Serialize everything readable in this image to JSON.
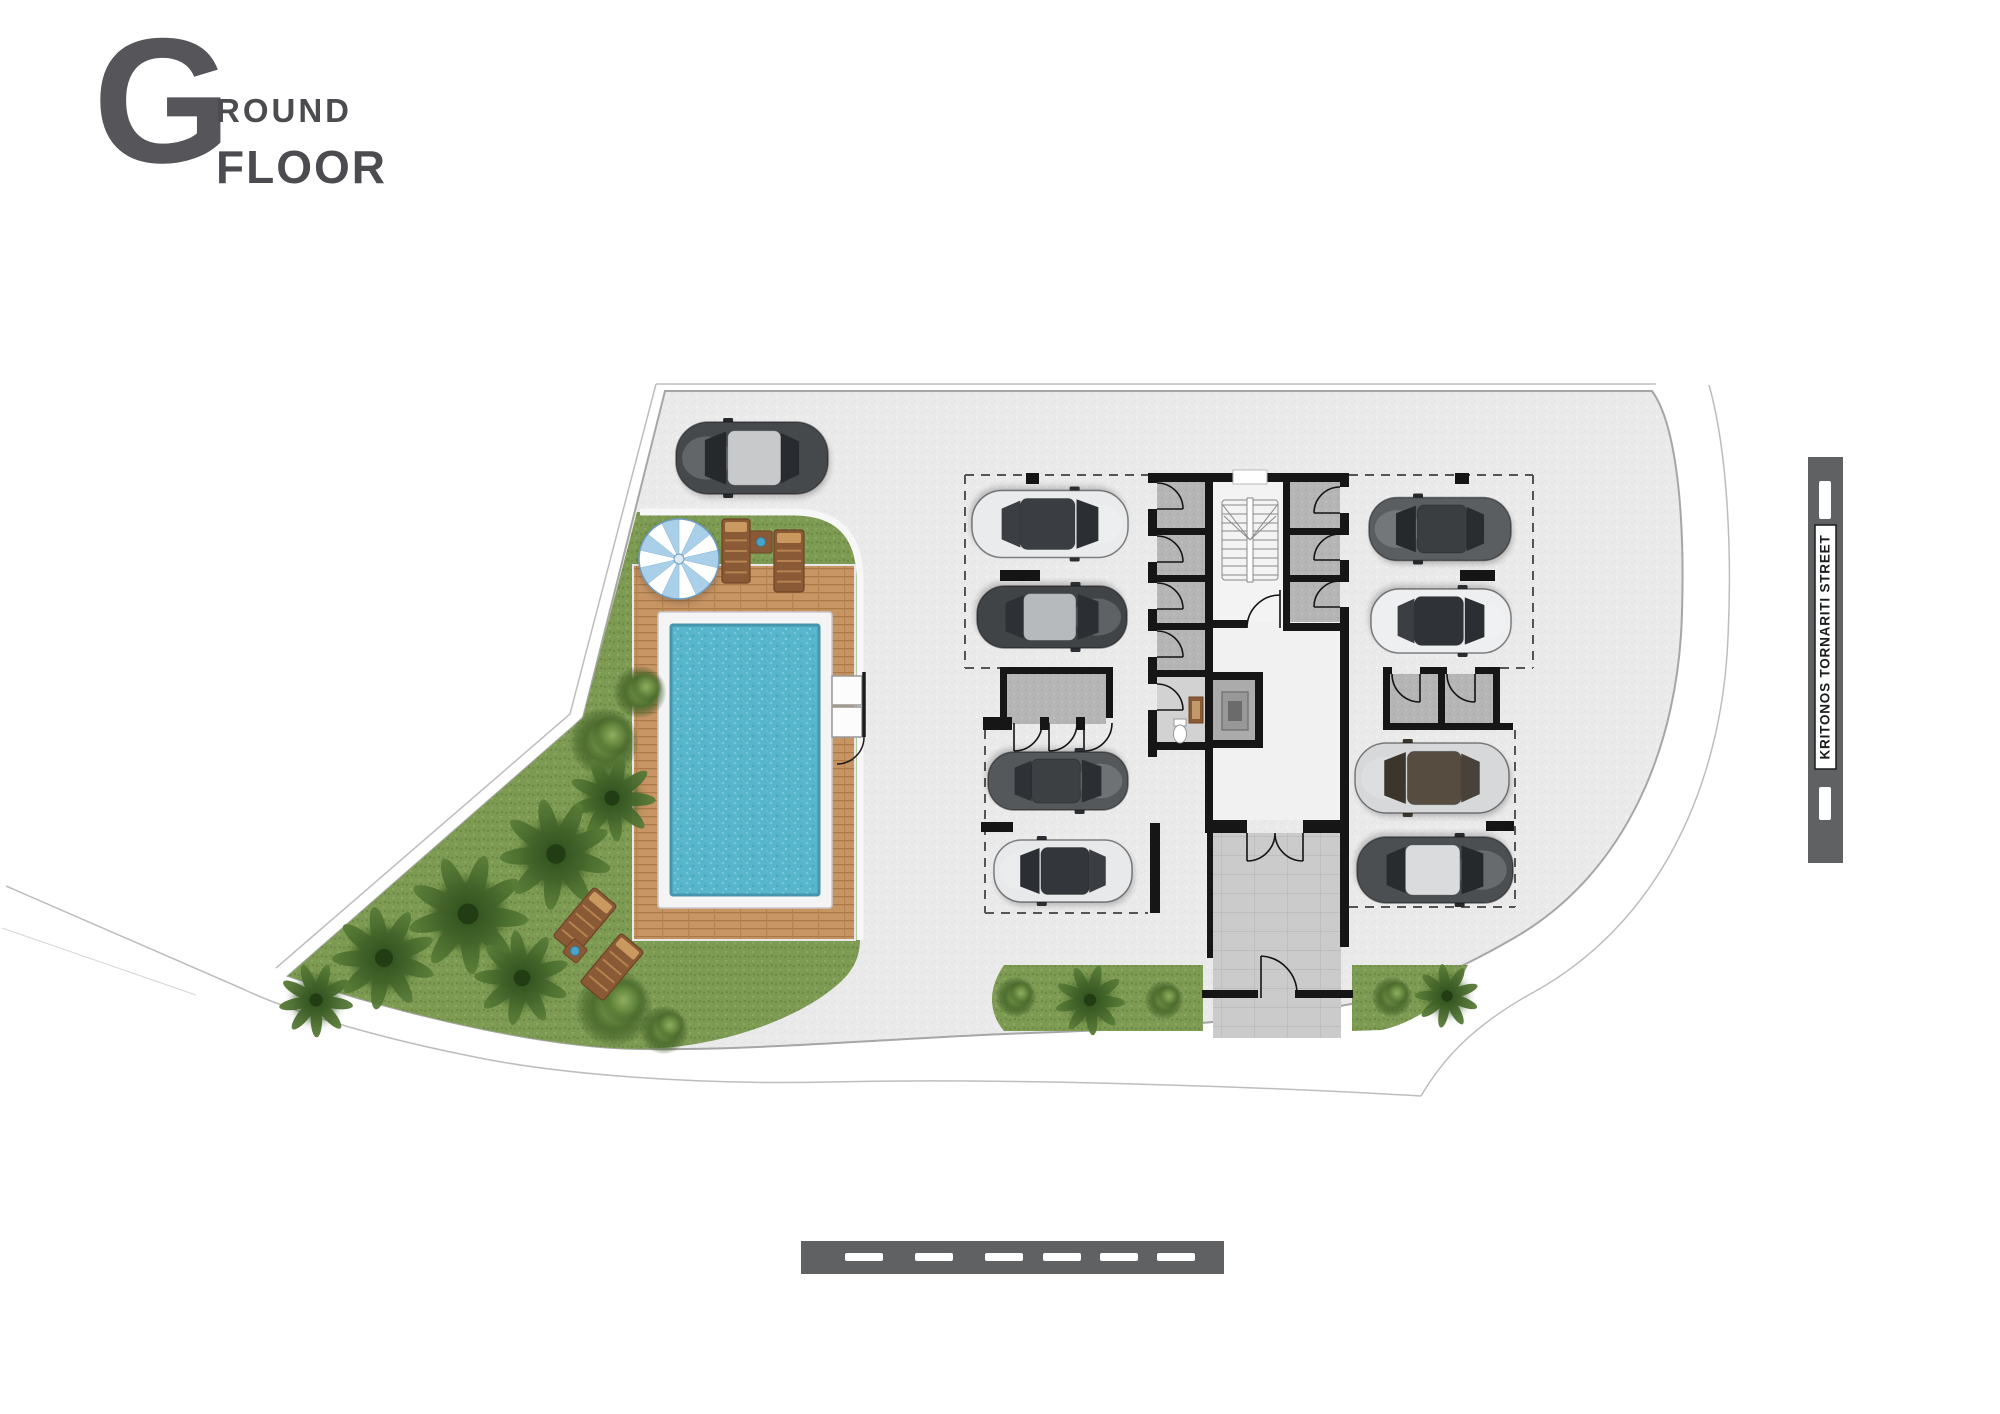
{
  "title": {
    "letter": "G",
    "word_top": "ROUND",
    "word_bottom": "FLOOR"
  },
  "street": {
    "name": "KRITONOS TORNARITI STREET"
  },
  "colors": {
    "paved": "#eaeaea",
    "sidewalk": "#ffffff",
    "grass": "#7d9b52",
    "deck": "#c79464",
    "pool_water": "#58b6cc",
    "pool_rim": "#f4f4f4",
    "wall": "#161616",
    "room_fill": "#b5b5b5",
    "tile_walk": "#cbcbcb",
    "street_bar": "#5f6163",
    "title_text": "#4c4c50",
    "umbrella_blue": "#aacfe8"
  },
  "plan": {
    "cars": [
      {
        "name": "suv-top-left",
        "x": 752,
        "y": 458,
        "len": 152,
        "wid": 72,
        "rot": 0,
        "body": "#46494c",
        "roof": "#c7c9cb",
        "glass": "#26292c"
      },
      {
        "name": "white-car-left-1",
        "x": 1050,
        "y": 524,
        "len": 156,
        "wid": 67,
        "rot": 180,
        "body": "#e9ebed",
        "roof": "#3a3e42",
        "glass": "#2b2f33"
      },
      {
        "name": "dark-car-left-2",
        "x": 1052,
        "y": 617,
        "len": 150,
        "wid": 62,
        "rot": 180,
        "body": "#404447",
        "roof": "#b7babc",
        "glass": "#2b2f33"
      },
      {
        "name": "gray-car-left-3",
        "x": 1058,
        "y": 781,
        "len": 140,
        "wid": 58,
        "rot": 180,
        "body": "#54585b",
        "roof": "#3c4043",
        "glass": "#2b2f33"
      },
      {
        "name": "white-car-left-4",
        "x": 1063,
        "y": 871,
        "len": 138,
        "wid": 62,
        "rot": 0,
        "body": "#e7e9eb",
        "roof": "#33373b",
        "glass": "#2b2f33"
      },
      {
        "name": "dark-car-right-1",
        "x": 1440,
        "y": 529,
        "len": 142,
        "wid": 63,
        "rot": 0,
        "body": "#5a5e61",
        "roof": "#3a3e41",
        "glass": "#26292c"
      },
      {
        "name": "white-car-right-2",
        "x": 1441,
        "y": 621,
        "len": 140,
        "wid": 64,
        "rot": 180,
        "body": "#edeff0",
        "roof": "#2f3337",
        "glass": "#2b2f33"
      },
      {
        "name": "silver-car-right-3",
        "x": 1432,
        "y": 778,
        "len": 154,
        "wid": 70,
        "rot": 0,
        "body": "#d6d8da",
        "roof": "#564c40",
        "glass": "#3c352c"
      },
      {
        "name": "suv-right-4",
        "x": 1435,
        "y": 870,
        "len": 156,
        "wid": 66,
        "rot": 180,
        "body": "#4b4f52",
        "roof": "#d9dbdc",
        "glass": "#26292c"
      }
    ],
    "parking_ticks": [
      {
        "x": 1026,
        "y": 473,
        "w": 13,
        "h": 11
      },
      {
        "x": 1000,
        "y": 570,
        "w": 40,
        "h": 11
      },
      {
        "x": 981,
        "y": 822,
        "w": 32,
        "h": 10
      },
      {
        "x": 1455,
        "y": 473,
        "w": 14,
        "h": 11
      },
      {
        "x": 1460,
        "y": 570,
        "w": 35,
        "h": 11
      },
      {
        "x": 1486,
        "y": 821,
        "w": 28,
        "h": 10
      }
    ],
    "dashed_lines": [
      {
        "x1": 965,
        "y1": 475,
        "x2": 1148,
        "y2": 475
      },
      {
        "x1": 965,
        "y1": 475,
        "x2": 965,
        "y2": 668
      },
      {
        "x1": 965,
        "y1": 668,
        "x2": 1000,
        "y2": 668
      },
      {
        "x1": 985,
        "y1": 730,
        "x2": 985,
        "y2": 913
      },
      {
        "x1": 985,
        "y1": 913,
        "x2": 1148,
        "y2": 913
      },
      {
        "x1": 1349,
        "y1": 475,
        "x2": 1533,
        "y2": 475
      },
      {
        "x1": 1533,
        "y1": 475,
        "x2": 1533,
        "y2": 668
      },
      {
        "x1": 1500,
        "y1": 668,
        "x2": 1533,
        "y2": 668
      },
      {
        "x1": 1515,
        "y1": 730,
        "x2": 1515,
        "y2": 907
      },
      {
        "x1": 1349,
        "y1": 907,
        "x2": 1515,
        "y2": 907
      }
    ],
    "palms": [
      {
        "x": 640,
        "y": 692,
        "r": 26,
        "k": "b"
      },
      {
        "x": 604,
        "y": 742,
        "r": 34,
        "k": "b"
      },
      {
        "x": 612,
        "y": 798,
        "r": 42,
        "k": "p"
      },
      {
        "x": 556,
        "y": 854,
        "r": 54,
        "k": "p"
      },
      {
        "x": 468,
        "y": 914,
        "r": 58,
        "k": "p"
      },
      {
        "x": 384,
        "y": 958,
        "r": 50,
        "k": "p"
      },
      {
        "x": 316,
        "y": 1000,
        "r": 36,
        "k": "p"
      },
      {
        "x": 522,
        "y": 978,
        "r": 46,
        "k": "p"
      },
      {
        "x": 614,
        "y": 1008,
        "r": 38,
        "k": "b"
      },
      {
        "x": 664,
        "y": 1030,
        "r": 24,
        "k": "b"
      },
      {
        "x": 1016,
        "y": 997,
        "r": 20,
        "k": "b"
      },
      {
        "x": 1090,
        "y": 1000,
        "r": 34,
        "k": "p"
      },
      {
        "x": 1164,
        "y": 1000,
        "r": 19,
        "k": "b"
      },
      {
        "x": 1392,
        "y": 997,
        "r": 20,
        "k": "b"
      },
      {
        "x": 1447,
        "y": 996,
        "r": 31,
        "k": "p"
      }
    ],
    "umbrella": {
      "x": 679,
      "y": 559,
      "r": 40,
      "wedges": 14
    },
    "loungers": [
      {
        "x": 736,
        "y": 551,
        "w": 28,
        "h": 64,
        "rot": 0
      },
      {
        "x": 789,
        "y": 561,
        "w": 30,
        "h": 62,
        "rot": 0
      },
      {
        "x": 585,
        "y": 921,
        "w": 30,
        "h": 64,
        "rot": 40
      },
      {
        "x": 612,
        "y": 967,
        "w": 30,
        "h": 64,
        "rot": 40
      }
    ],
    "side_tables": [
      {
        "x": 761,
        "y": 542,
        "s": 22,
        "rot": 0
      },
      {
        "x": 575,
        "y": 951,
        "s": 18,
        "rot": 40
      }
    ],
    "street_bar": {
      "x": 1808,
      "y": 457,
      "w": 35,
      "h": 406,
      "dashes": [
        {
          "y": 481,
          "h": 38
        },
        {
          "y": 787,
          "h": 33
        }
      ],
      "label_box": {
        "x": 1815,
        "y": 525,
        "w": 21,
        "h": 244
      }
    },
    "road_bottom": {
      "x": 801,
      "y": 1241,
      "w": 423,
      "h": 33,
      "dash_y": 1253,
      "dash_w": 38,
      "dash_h": 8,
      "dash_xs": [
        845,
        915,
        985,
        1043,
        1100,
        1157
      ]
    }
  }
}
